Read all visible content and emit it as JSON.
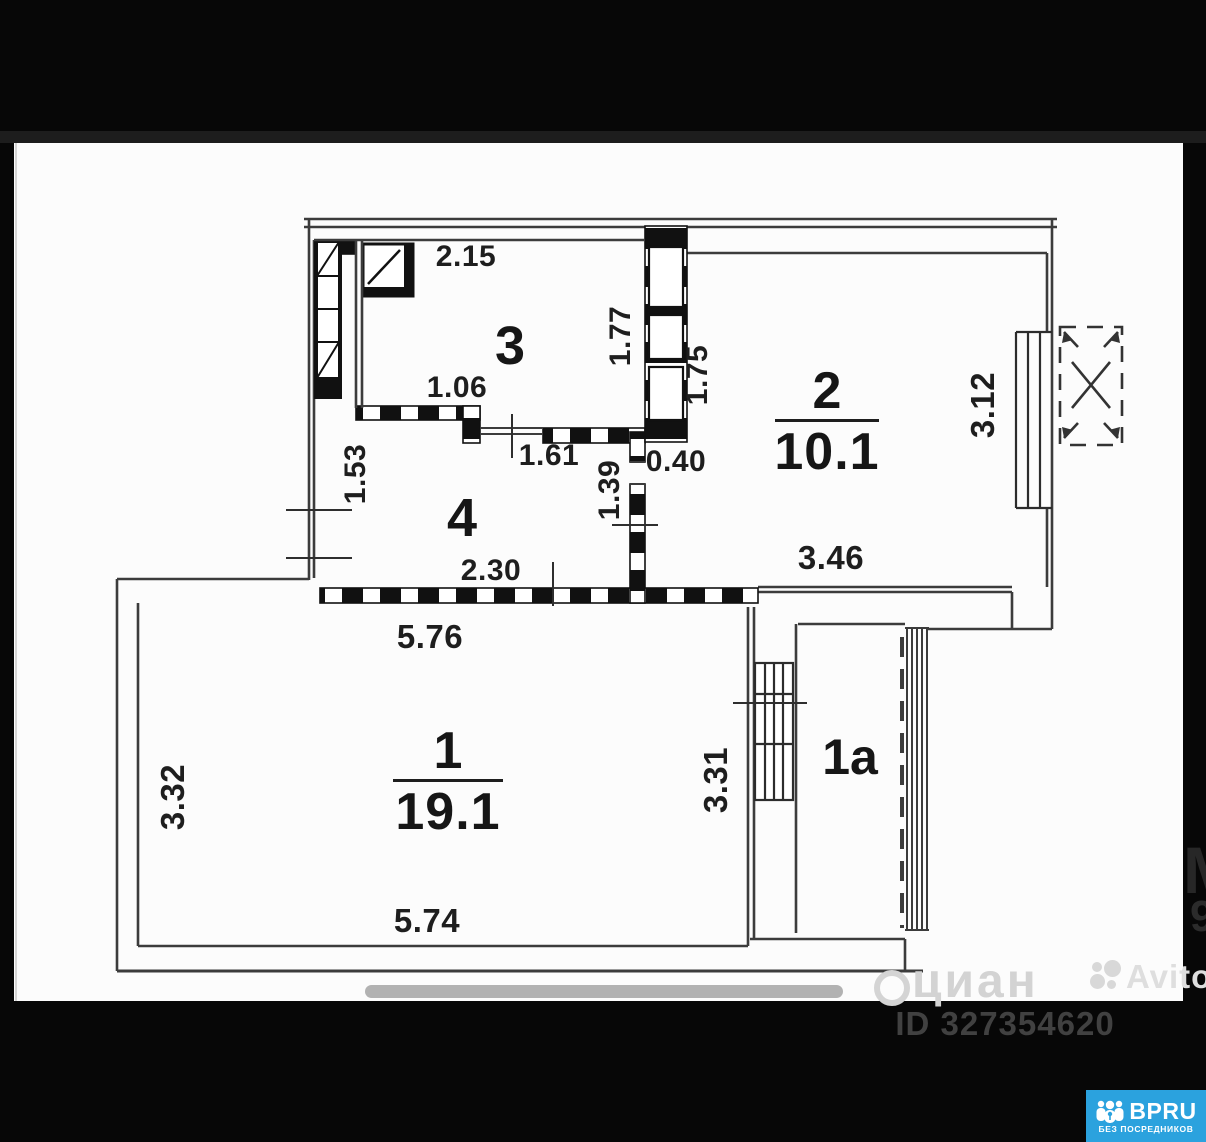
{
  "floorplan": {
    "rooms": [
      {
        "number": "3"
      },
      {
        "number": "4"
      },
      {
        "number": "2",
        "area": "10.1"
      },
      {
        "number": "1",
        "area": "19.1"
      },
      {
        "number": "1a"
      }
    ],
    "dims": {
      "d215": "2.15",
      "d106": "1.06",
      "d177": "1.77",
      "d175": "1.75",
      "d153": "1.53",
      "d161": "1.61",
      "d040": "0.40",
      "d139": "1.39",
      "d230": "2.30",
      "d576": "5.76",
      "d346": "3.46",
      "d312": "3.12",
      "d332": "3.32",
      "d574": "5.74",
      "d331": "3.31"
    }
  },
  "watermarks": {
    "cian": "циан",
    "avito": "Avito",
    "fragment_top": "М",
    "fragment_bottom": "9"
  },
  "footer": {
    "listing_id": "ID 327354620"
  },
  "badge": {
    "brand": "BPRU",
    "tagline": "БЕЗ ПОСРЕДНИКОВ"
  },
  "colors": {
    "badge_blue": "#2ba2de",
    "wall_line": "#3c3c3c",
    "hatch_black": "#111111",
    "watermark_gray": "#d3d3d3",
    "scroll_gray": "#b2b2b2"
  }
}
